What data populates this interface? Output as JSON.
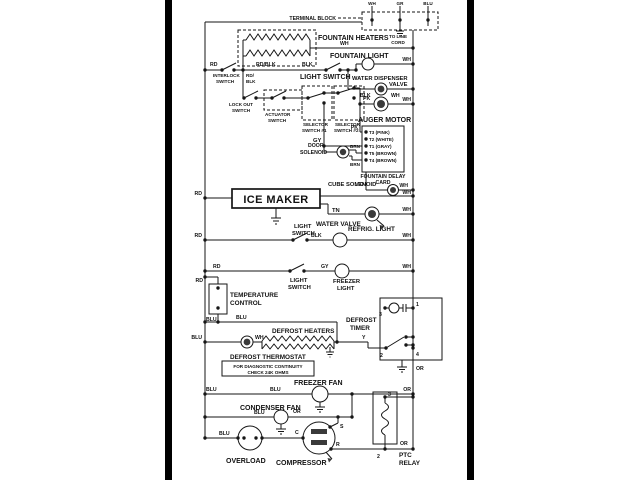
{
  "diagram": {
    "type": "wiring-schematic",
    "subject": "refrigerator electrical wiring diagram",
    "colors": {
      "ink": "#161616",
      "paper": "#ffffff",
      "edge_bar": "#000000"
    },
    "labels": {
      "terminal_block": "TERMINAL BLOCK",
      "to_line": "TO LINE",
      "cord": "CORD",
      "wh": "WH",
      "gr": "GR",
      "blu": "BLU",
      "rd": "RD",
      "rd_slash": "RD/",
      "rd_blk": "RD/BLK",
      "blk": "BLK",
      "gy": "GY",
      "pk": "PK",
      "tn": "TN",
      "or": "OR",
      "brn": "BRN",
      "vio": "VIO",
      "y": "Y",
      "fountain_heaters": "FOUNTAIN HEATERS",
      "fountain_light": "FOUNTAIN LIGHT",
      "light_switch": "LIGHT SWITCH",
      "light": "LIGHT",
      "switch": "SWITCH",
      "interlock": "INTERLOCK",
      "lock_out": "LOCK OUT",
      "actuator": "ACTUATOR",
      "selector": "SELECTOR",
      "switch_no1": "SWITCH #1",
      "switch_no2": "SWITCH #2",
      "water_dispenser": "WATER DISPENSER",
      "valve": "VALVE",
      "auger_motor": "AUGER MOTOR",
      "door": "DOOR",
      "solenoid": "SOLENOID",
      "t3_pink": "T3 (PINK)",
      "t2_white": "T2 (WHITE)",
      "t1_gray": "T1 (GRAY)",
      "t5_brown": "T5 (BROWN)",
      "t4_brown": "T4 (BROWN)",
      "fountain_delay": "FOUNTAIN DELAY",
      "card": "CARD",
      "cube_solenoid": "CUBE SOLENOID",
      "ice_maker": "ICE MAKER",
      "water_valve": "WATER VALVE",
      "refrig_light": "REFRIG. LIGHT",
      "freezer": "FREEZER",
      "temperature": "TEMPERATURE",
      "control": "CONTROL",
      "defrost": "DEFROST",
      "timer": "TIMER",
      "defrost_heaters": "DEFROST HEATERS",
      "defrost_thermostat": "DEFROST THERMOSTAT",
      "diag_line1": "FOR DIAGNOSTIC CONTINUITY",
      "diag_line2": "CHECK 24K OHMS",
      "freezer_fan": "FREEZER FAN",
      "condenser_fan": "CONDENSER FAN",
      "overload": "OVERLOAD",
      "compressor": "COMPRESSOR",
      "ptc": "PTC",
      "relay": "RELAY",
      "n1": "1",
      "n2": "2",
      "n3": "3",
      "n4": "4",
      "c": "C",
      "s": "S",
      "r": "R"
    }
  }
}
